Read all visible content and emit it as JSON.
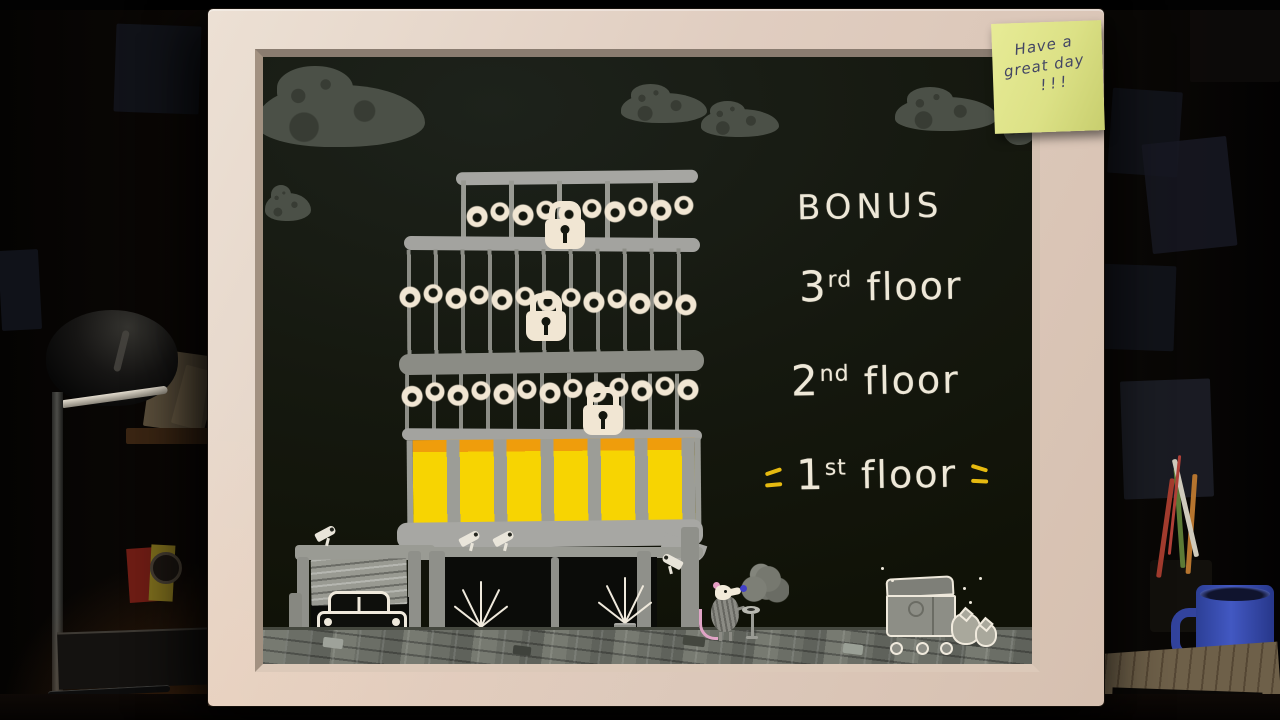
{
  "scene": "hand-drawn building floor-select board in a dark cluttered office",
  "sticky_note": {
    "line1": "Have a",
    "line2": "great day",
    "line3": "!!!"
  },
  "menu": {
    "bonus": {
      "label": "BONUS",
      "locked": true
    },
    "floors": [
      {
        "num": "3",
        "suffix": "rd",
        "word": "floor",
        "locked": true
      },
      {
        "num": "2",
        "suffix": "nd",
        "word": "floor",
        "locked": true
      },
      {
        "num": "1",
        "suffix": "st",
        "word": "floor",
        "locked": false,
        "selected": true
      }
    ]
  },
  "icons": {
    "padlock": "css-shape",
    "chain": "repeating radial-gradient links",
    "security-camera": "css-shape",
    "potted-plant": "css-line-burst",
    "car": "css-shape",
    "garage-door": "css-stripes",
    "rat-character": "css-shape",
    "smoke-cloud": "css-blob",
    "ashtray-stand": "css-shape",
    "dumpster": "css-shape",
    "trash-bag": "css-blob",
    "cloud": "css-blob",
    "desk-lamp": "css-shape",
    "mug": "css-shape"
  },
  "colors": {
    "board_background": "#171a14",
    "chalk_white": "#eee8d8",
    "window_yellow": "#f7d402",
    "window_orange": "#ef9d0c",
    "building_grey": "#9a9b94",
    "highlight_dash_yellow": "#e6ba10",
    "frame_beige": "#e0cdc0",
    "sticky_note_yellow": "#dce186",
    "sticky_note_ink": "#434664"
  }
}
